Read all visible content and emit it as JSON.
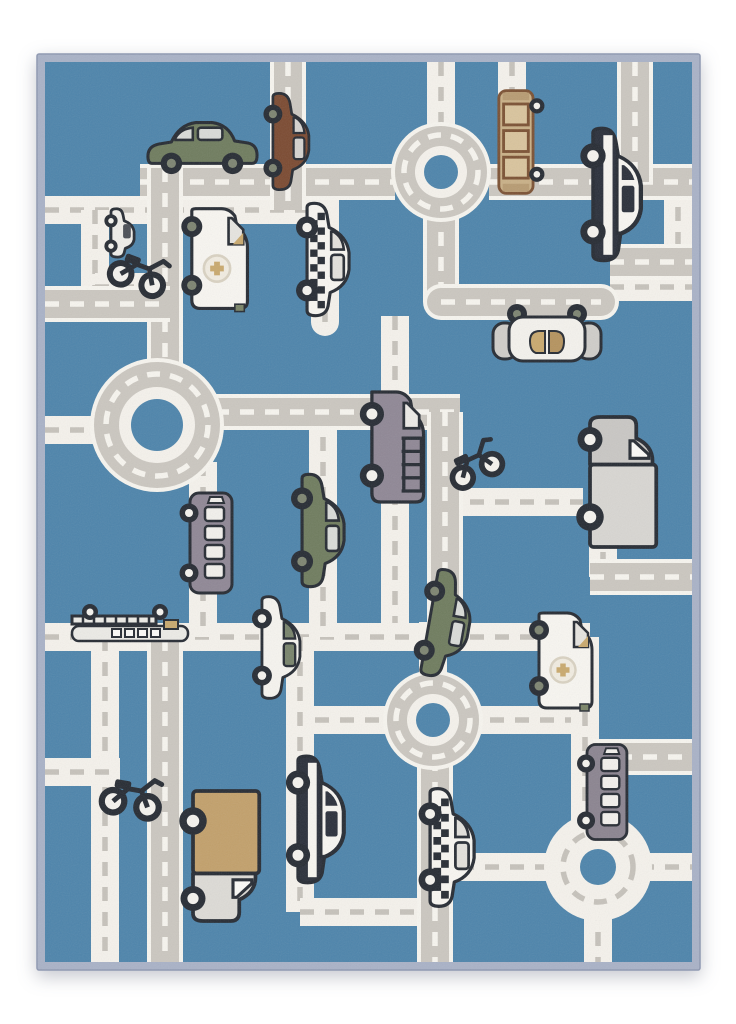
{
  "scene": {
    "description": "Product photo of a children's city road play rug: blue carpet printed with gray and white roads, roundabouts and cartoon vehicles, periwinkle bound edge, on a white background",
    "rug": {
      "x": 45,
      "y": 62,
      "width": 647,
      "height": 900,
      "binding_width": 8
    }
  },
  "palette": {
    "page_bg": "#ffffff",
    "binding": "#a9b2c7",
    "binding_edge": "#8f99b2",
    "rug_blue": "#4d84ab",
    "road_gray": "#cbc7c0",
    "road_white": "#f5f2ec",
    "road_edge": "#f7f5ef",
    "dash_white": "#f7f5ef",
    "dash_gray": "#c6c2bb",
    "outline": "#262b33",
    "navy": "#2a2f3a",
    "white_body": "#f8f6f1",
    "tan": "#c9a96e",
    "tan_light": "#c9b087",
    "brown": "#7b5133",
    "olive": "#7a8467",
    "purple": "#8f8795"
  },
  "white_roads": [
    [
      "h",
      0,
      148,
      294
    ],
    [
      "v",
      280,
      148,
      112,
      "round"
    ],
    [
      "v",
      50,
      148,
      77
    ],
    [
      "h",
      50,
      225,
      78
    ],
    [
      "v",
      350,
      254,
      321
    ],
    [
      "h",
      0,
      575,
      545
    ],
    [
      "v",
      278,
      350,
      225
    ],
    [
      "v",
      158,
      400,
      175
    ],
    [
      "h",
      245,
      658,
      105
    ],
    [
      "h",
      420,
      658,
      120
    ],
    [
      "v",
      540,
      575,
      200
    ],
    [
      "h",
      595,
      805,
      52
    ],
    [
      "v",
      553,
      845,
      55
    ],
    [
      "h",
      415,
      805,
      100
    ],
    [
      "v",
      60,
      575,
      325
    ],
    [
      "v",
      255,
      575,
      275
    ],
    [
      "h",
      255,
      850,
      135
    ],
    [
      "v",
      633,
      120,
      110
    ],
    [
      "h",
      565,
      225,
      82
    ],
    [
      "v",
      396,
      0,
      70
    ],
    [
      "v",
      467,
      0,
      120
    ],
    [
      "h",
      400,
      440,
      138
    ],
    [
      "v",
      558,
      440,
      75
    ],
    [
      "h",
      0,
      368,
      55
    ],
    [
      "v",
      388,
      560,
      55
    ],
    [
      "h",
      0,
      710,
      75
    ]
  ],
  "gray_roads": [
    [
      "h",
      95,
      120,
      255
    ],
    [
      "h",
      444,
      120,
      203
    ],
    [
      "v",
      243,
      0,
      148
    ],
    [
      "v",
      590,
      0,
      120
    ],
    [
      "v",
      120,
      106,
      224
    ],
    [
      "h",
      0,
      242,
      125
    ],
    [
      "h",
      170,
      350,
      245
    ],
    [
      "v",
      400,
      350,
      225
    ],
    [
      "v",
      396,
      145,
      95
    ],
    [
      "h",
      396,
      240,
      160,
      "round"
    ],
    [
      "v",
      390,
      695,
      205
    ],
    [
      "h",
      548,
      695,
      99
    ],
    [
      "h",
      565,
      200,
      82
    ],
    [
      "h",
      545,
      515,
      102
    ],
    [
      "v",
      120,
      575,
      325
    ]
  ],
  "roundabouts": [
    {
      "x": 396,
      "y": 110,
      "kind": "gray",
      "out": 50,
      "dash": 37,
      "inner": 26,
      "center": 17
    },
    {
      "x": 112,
      "y": 363,
      "kind": "gray",
      "out": 67,
      "dash": 51,
      "inner": 38,
      "center": 26
    },
    {
      "x": 388,
      "y": 658,
      "kind": "gray",
      "out": 50,
      "dash": 37,
      "inner": 26,
      "center": 17
    },
    {
      "x": 553,
      "y": 805,
      "kind": "white",
      "out": 54,
      "dash": 35,
      "inner": 0,
      "center": 18
    }
  ],
  "vehicles": [
    {
      "name": "green-sedan",
      "type": "sedan",
      "x": 158,
      "y": 82,
      "rot": 0,
      "s": 1.02,
      "vars": {
        "body": "#6f7c5e",
        "win": "#d9dbd8",
        "hub": "#7d8471"
      }
    },
    {
      "name": "brown-car",
      "type": "sedan",
      "x": 245,
      "y": 80,
      "rot": 90,
      "s": 0.9,
      "vars": {
        "body": "#7b4a31",
        "win": "#d5d3cf",
        "hub": "#7d8471"
      }
    },
    {
      "name": "brown-tram",
      "type": "tram",
      "x": 470,
      "y": 80,
      "rot": 90,
      "s": 0.95,
      "vars": {}
    },
    {
      "name": "police-car",
      "type": "police",
      "x": 571,
      "y": 133,
      "rot": 90,
      "s": 1.15,
      "vars": {}
    },
    {
      "name": "mini-car",
      "type": "minicar",
      "x": 77,
      "y": 172,
      "rot": 90,
      "s": 1.1,
      "vars": {}
    },
    {
      "name": "motorcycle",
      "type": "moto",
      "x": 94,
      "y": 207,
      "rot": 20,
      "s": 1.2,
      "vars": {}
    },
    {
      "name": "ambulance",
      "type": "ambulance",
      "x": 172,
      "y": 196,
      "rot": 90,
      "s": 1.05,
      "vars": {}
    },
    {
      "name": "taxi",
      "type": "taxi",
      "x": 282,
      "y": 198,
      "rot": 90,
      "s": 1.05,
      "vars": {}
    },
    {
      "name": "top-view-car",
      "type": "topcar",
      "x": 502,
      "y": 276,
      "rot": 0,
      "s": 1.0,
      "vars": {}
    },
    {
      "name": "purple-van",
      "type": "van",
      "x": 350,
      "y": 385,
      "rot": 90,
      "s": 1.1,
      "vars": {}
    },
    {
      "name": "green-car",
      "type": "sedan",
      "x": 277,
      "y": 469,
      "rot": 90,
      "s": 1.05,
      "vars": {
        "body": "#6f7c5e",
        "win": "#d9dbd8",
        "hub": "#7d8471"
      }
    },
    {
      "name": "purple-bus",
      "type": "bus",
      "x": 165,
      "y": 481,
      "rot": 90,
      "s": 1.0,
      "vars": {
        "body": "#8f8795",
        "win": "#f2f0ec"
      }
    },
    {
      "name": "motorcycle",
      "type": "moto",
      "x": 427,
      "y": 400,
      "rot": -25,
      "s": 1.15,
      "vars": {}
    },
    {
      "name": "gray-box-truck",
      "type": "boxtruck",
      "x": 575,
      "y": 420,
      "rot": 90,
      "s": 1.25,
      "vars": {
        "cab": "#c9c7c4",
        "box": "#d8d6d2"
      }
    },
    {
      "name": "ladder-truck",
      "type": "laddertruck",
      "x": 85,
      "y": 563,
      "rot": 0,
      "s": 1.0,
      "vars": {}
    },
    {
      "name": "white-sedan",
      "type": "sedan",
      "x": 235,
      "y": 586,
      "rot": 90,
      "s": 0.95,
      "vars": {
        "body": "#f6f4ef",
        "win": "#78836b",
        "hub": "#f5f3ee"
      }
    },
    {
      "name": "green-sedan-tilted",
      "type": "sedan",
      "x": 403,
      "y": 563,
      "rot": 100,
      "s": 1.0,
      "vars": {
        "body": "#6f7c5e",
        "win": "#d9dbd8",
        "hub": "#7d8471"
      }
    },
    {
      "name": "ambulance",
      "type": "ambulance",
      "x": 518,
      "y": 598,
      "rot": 90,
      "s": 1.0,
      "vars": {}
    },
    {
      "name": "gray-bus",
      "type": "bus",
      "x": 561,
      "y": 730,
      "rot": 90,
      "s": 0.95,
      "vars": {
        "body": "#8b8490",
        "win": "#f2f0ec"
      }
    },
    {
      "name": "police-car",
      "type": "police",
      "x": 275,
      "y": 758,
      "rot": 90,
      "s": 1.1,
      "vars": {}
    },
    {
      "name": "tan-box-truck",
      "type": "boxtruck",
      "x": 178,
      "y": 794,
      "rot": -90,
      "flip": true,
      "s": 1.25,
      "vars": {
        "cab": "#dddbd6",
        "box": "#c2a06b"
      }
    },
    {
      "name": "taxi",
      "type": "taxi",
      "x": 406,
      "y": 786,
      "rot": 90,
      "s": 1.1,
      "vars": {}
    },
    {
      "name": "motorcycle",
      "type": "moto",
      "x": 86,
      "y": 731,
      "rot": 10,
      "s": 1.25,
      "vars": {}
    }
  ]
}
